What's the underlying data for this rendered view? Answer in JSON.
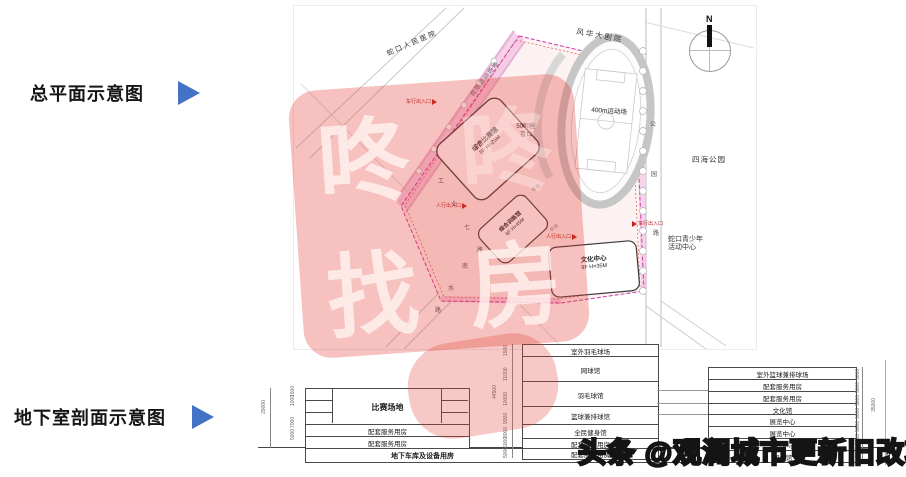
{
  "colors": {
    "accent_blue": "#4472c4",
    "watermark_red": "#e23e34",
    "boundary_magenta": "#cc3aa8"
  },
  "captions": {
    "site_plan": "总平面示意图",
    "basement_section": "地下室剖面示意图"
  },
  "site_plan": {
    "compass": "N",
    "surroundings": {
      "hospital": "蛇口人民医院",
      "theater": "风华大剧院",
      "park": "四海公园",
      "youth_center_line1": "蛇口青少年",
      "youth_center_line2": "活动中心",
      "extreme_sports": "极限运动场地"
    },
    "roads": {
      "industrial_rd": [
        "工",
        "业",
        "七",
        "路"
      ],
      "nanshui_rd": [
        "南",
        "水",
        "路"
      ],
      "park_rd": [
        "公",
        "园",
        "路"
      ]
    },
    "venues": {
      "track": "400m运动场",
      "stand_line1": "5000座",
      "stand_line2": "看台",
      "platform": "平台",
      "buildings": [
        {
          "name": "综合比赛馆",
          "spec": "5F  H=25M"
        },
        {
          "name": "综合训练馆",
          "spec": "6F  H=45M"
        },
        {
          "name": "文化中心",
          "spec": "9F  H=35M"
        }
      ]
    },
    "entrances": {
      "vehicle": "车行出入口",
      "pedestrian": "人行出入口"
    }
  },
  "watermark": {
    "chars": [
      "咚",
      "咚",
      "找",
      "房"
    ]
  },
  "sections": {
    "left": {
      "rows": [
        {
          "label": "比赛场地"
        },
        {
          "label": "配套服务用房"
        },
        {
          "label": "配套服务用房"
        }
      ],
      "garage": "地下车库及设备用房",
      "dims": {
        "outer": "29000",
        "inner": [
          "1500",
          "1000",
          "7000",
          "5000"
        ]
      }
    },
    "middle": {
      "rows": [
        "室外羽毛球场",
        "网球馆",
        "羽毛球馆",
        "篮球兼排球馆",
        "全民健身馆",
        "配套服务用房",
        "配套服务用房"
      ],
      "dims": [
        "1500",
        "11000",
        "10000",
        "9000",
        "8000",
        "6000",
        "5000"
      ],
      "outer_dim": "44500"
    },
    "right": {
      "rows": [
        "室外篮球兼排球场",
        "配套服务用房",
        "配套服务用房",
        "文化馆",
        "展览中心",
        "展览中心",
        "展览中心",
        "图书馆"
      ],
      "dims": [
        "5000",
        "5000",
        "5000",
        "5000",
        "5000",
        "5000",
        "5000"
      ],
      "outer_dim": "35000"
    }
  },
  "footer": {
    "credit": "头条 @观澜城市更新旧改项目"
  }
}
